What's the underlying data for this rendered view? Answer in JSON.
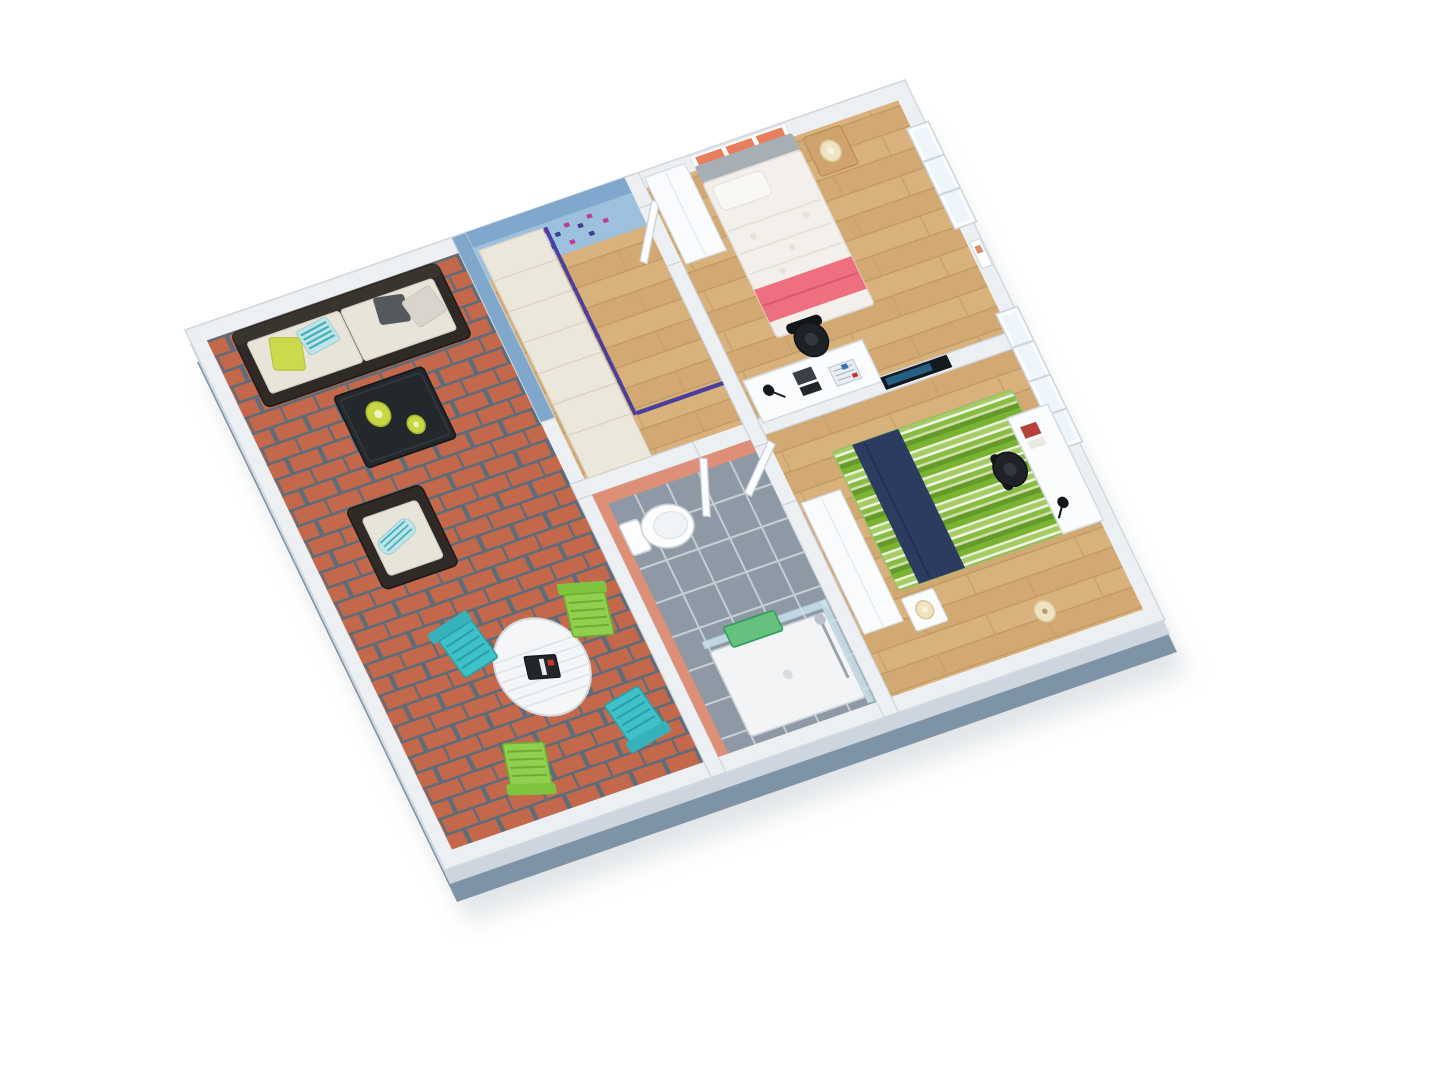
{
  "scene": {
    "type": "3d-floor-plan-render",
    "view": "isometric-dollhouse-top",
    "background": "#ffffff",
    "rooms": [
      {
        "name": "terrace",
        "floor": "red-brick-paving",
        "furniture": [
          "dark-wicker-sofa-with-cream-cushions",
          "pillows-lime-teal-grey",
          "dark-wicker-coffee-table",
          "two-lime-vases",
          "dark-wicker-armchair",
          "white-round-slat-table",
          "book-on-table",
          "turquoise-folding-chair",
          "green-folding-chair",
          "turquoise-folding-chair",
          "green-folding-chair"
        ]
      },
      {
        "name": "stair-hall",
        "floor": "oak-landing",
        "features": [
          "blue-accent-wall",
          "animal-wall-decals-pink-navy",
          "winder-staircase-cream",
          "purple-railing"
        ]
      },
      {
        "name": "bathroom",
        "floor": "grey-tile",
        "features": [
          "salmon-wall-tiles"
        ],
        "furniture": [
          "white-toilet",
          "shower-tray-glass-enclosure",
          "green-towel",
          "shower-column",
          "white-door-open"
        ]
      },
      {
        "name": "bedroom-1",
        "floor": "oak-plank",
        "furniture": [
          "double-bed-white-duvet-pink-throw",
          "grey-headboard",
          "orange-white-wall-shelf",
          "picture-frame",
          "floating-nightstand-with-lamp",
          "white-desk",
          "black-office-chair",
          "desk-lamp-books-notebook",
          "white-wardrobe",
          "wall-tv",
          "white-door-open"
        ]
      },
      {
        "name": "bedroom-2",
        "floor": "oak-plank",
        "furniture": [
          "bed-green-striped-duvet-navy-throw",
          "white-wardrobe",
          "nightstand-with-lamp",
          "floor-lamp",
          "white-desk",
          "black-office-chair",
          "desk-lamp-books",
          "white-door-open"
        ]
      }
    ],
    "windows": [
      "bedroom-1-right-wall",
      "bedroom-2-right-wall"
    ]
  },
  "palette": {
    "background": "#ffffff",
    "wall_top": "#edf0f3",
    "wall_stroke": "#d2d9df",
    "wall_mid_face": "#cdd6de",
    "outer_wall": "#7e93a5",
    "brick": "#c4684c",
    "mortar": "#5f6c78",
    "wood": "#d8b17c",
    "tile": "#8e99a5",
    "accent_blue": "#9cc0de",
    "accent_blue_deep": "#7fa8cc",
    "salmon": "#dd8f78",
    "stair_cream": "#ece7db",
    "railing_purple": "#4a3f9f",
    "decal_magenta": "#c13a8c",
    "decal_navy": "#3d3f90",
    "duvet_white": "#f3f0ec",
    "pink": "#ed6f80",
    "headboard_grey": "#a7afb5",
    "navy": "#2c3b60",
    "stripe_green": "#7ab331",
    "turquoise": "#3fc1c9",
    "chair_green": "#8fd14f",
    "rattan_dark": "#2f2a26",
    "cushion_cream": "#e9e4da",
    "vase_lime": "#c8d844",
    "towel_green": "#66c17f",
    "shelf_orange": "#e87e5c",
    "chair_black": "#1e2227",
    "glass": "#cfe6ee"
  }
}
